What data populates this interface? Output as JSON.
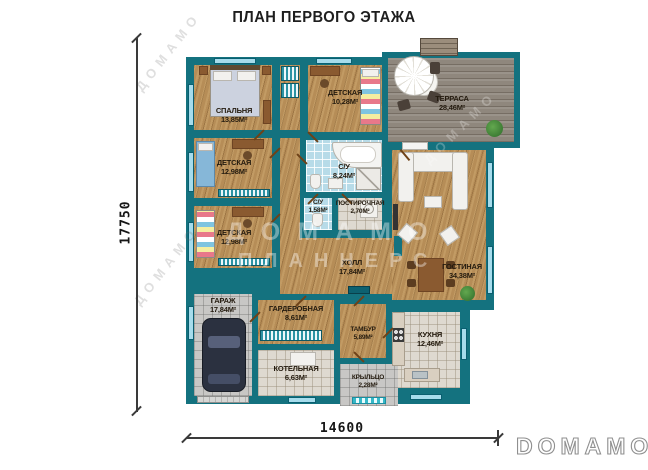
{
  "title": "ПЛАН ПЕРВОГО ЭТАЖА",
  "dimensions": {
    "vertical": "17750",
    "horizontal": "14600"
  },
  "brand": {
    "logo": "DOMAMO"
  },
  "watermark": {
    "line1": "ДОМАМО",
    "line2": "ПЛАННЕРС"
  },
  "rooms": {
    "bedroom": {
      "name": "СПАЛЬНЯ",
      "area": "13,85м²"
    },
    "kids_top": {
      "name": "ДЕТСКАЯ",
      "area": "10,28м²"
    },
    "terrace": {
      "name": "ТЕРРАСА",
      "area": "28,46м²"
    },
    "kids_mid": {
      "name": "ДЕТСКАЯ",
      "area": "12,98м²"
    },
    "bathroom": {
      "name": "С/У",
      "area": "8,24м²"
    },
    "kids_low": {
      "name": "ДЕТСКАЯ",
      "area": "12,98м²"
    },
    "wc": {
      "name": "С/У",
      "area": "1,58м²"
    },
    "laundry": {
      "name": "ПОСТИРОЧНАЯ",
      "area": "2,70м²"
    },
    "hall": {
      "name": "ХОЛЛ",
      "area": "17,84м²"
    },
    "living": {
      "name": "ГОСТИНАЯ",
      "area": "34,38м²"
    },
    "garage": {
      "name": "ГАРАЖ",
      "area": "17,84м²"
    },
    "wardrobe": {
      "name": "ГАРДЕРОБНАЯ",
      "area": "8,61м²"
    },
    "vestibule": {
      "name": "ТАМБУР",
      "area": "5,89м²"
    },
    "kitchen": {
      "name": "КУХНЯ",
      "area": "12,46м²"
    },
    "boiler": {
      "name": "КОТЕЛЬНАЯ",
      "area": "6,63м²"
    },
    "porch": {
      "name": "КРЫЛЬЦО",
      "area": "2,28м²"
    }
  },
  "colors": {
    "wall": "#14727f",
    "wood": "#b68d57",
    "deck": "#8f877d",
    "tile_blue": "#b7dbe8",
    "tile_light": "#ded9d0",
    "window": "#a6dcec"
  }
}
